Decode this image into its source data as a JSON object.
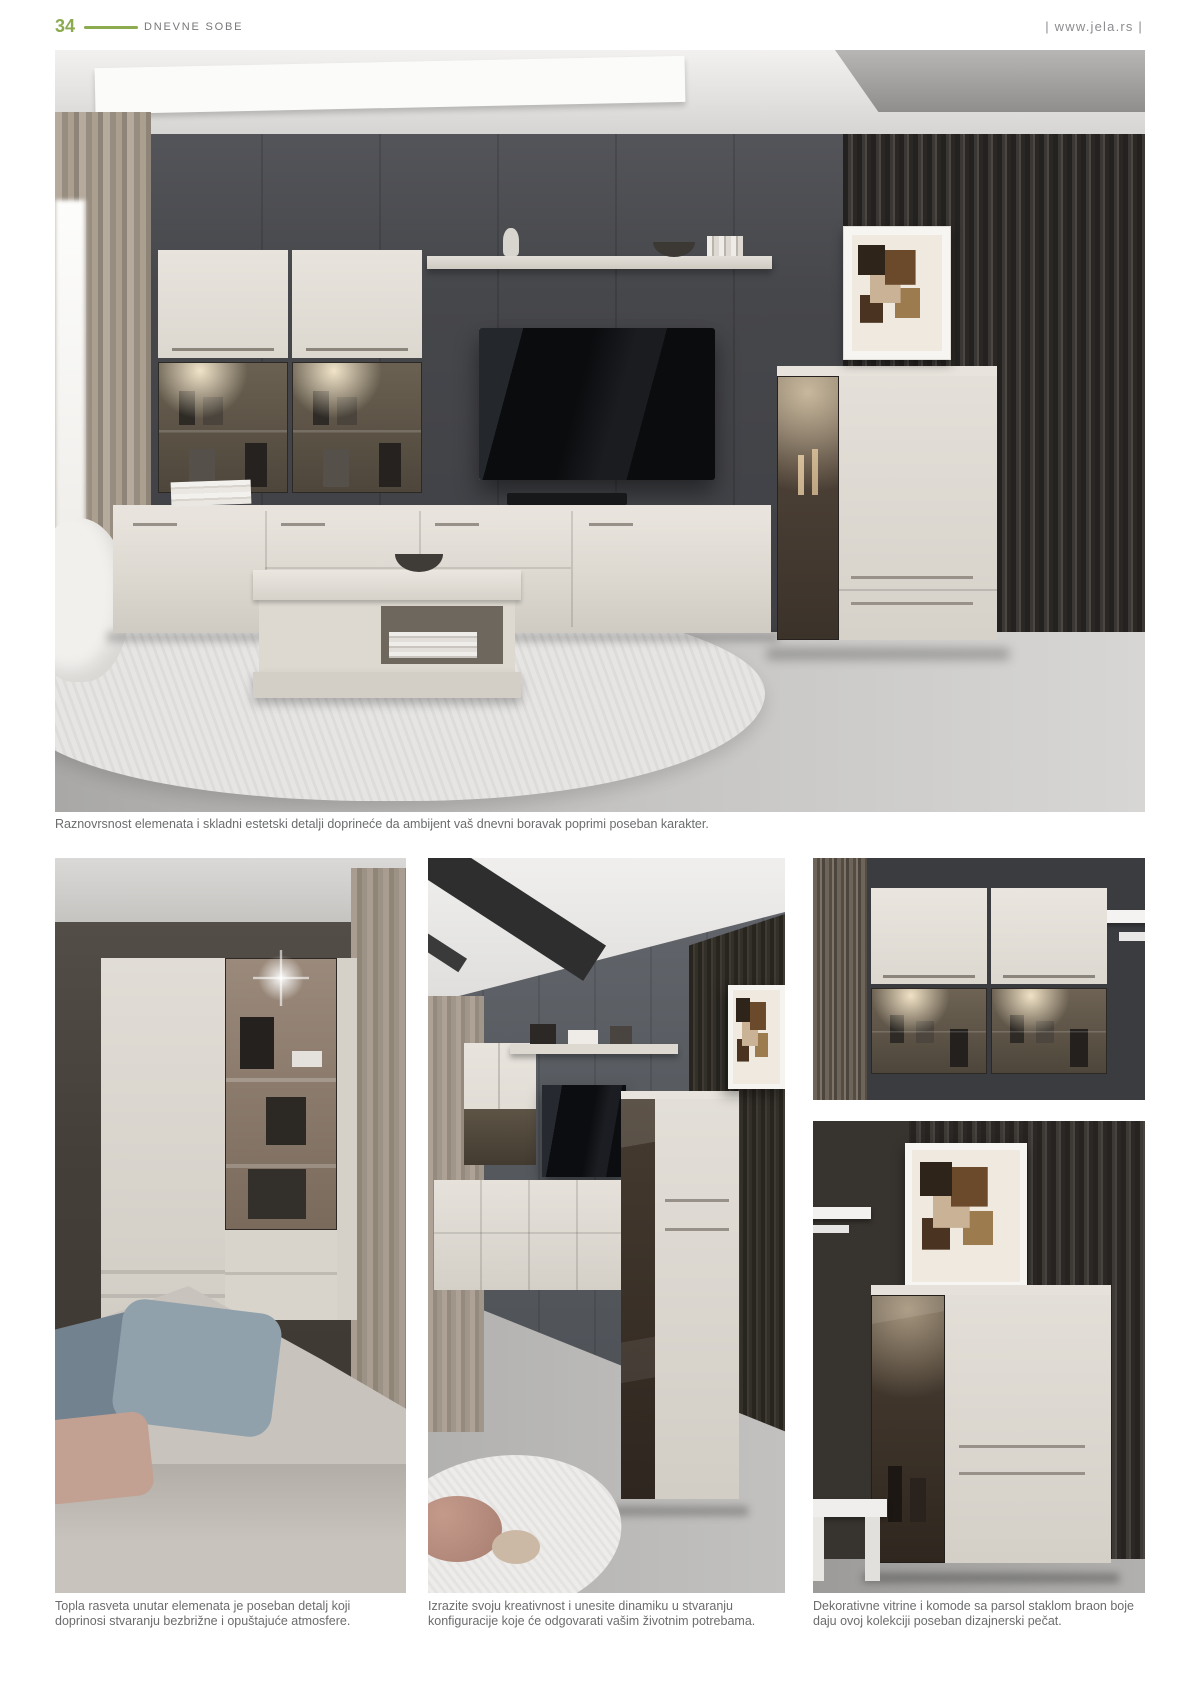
{
  "header": {
    "page_number": "34",
    "section_title": "DNEVNE SOBE",
    "website": "| www.jela.rs |"
  },
  "hero": {
    "caption": "Raznovrsnost elemenata i skladni estetski detalji doprineće da ambijent vaš dnevni boravak poprimi poseban karakter."
  },
  "captions": {
    "left": "Topla rasveta unutar elemenata je poseban detalj koji doprinosi stvaranju bezbrižne i opuštajuće atmosfere.",
    "middle": "Izrazite svoju kreativnost i unesite dinamiku u stvaranju konfiguracije koje će odgovarati vašim životnim potrebama.",
    "right": "Dekorativne vitrine i komode sa parsol staklom braon boje daju ovoj kolekciji poseban dizajnerski pečat."
  },
  "colors": {
    "accent_green": "#8caa4e",
    "caption_gray": "#6b6c6e"
  }
}
